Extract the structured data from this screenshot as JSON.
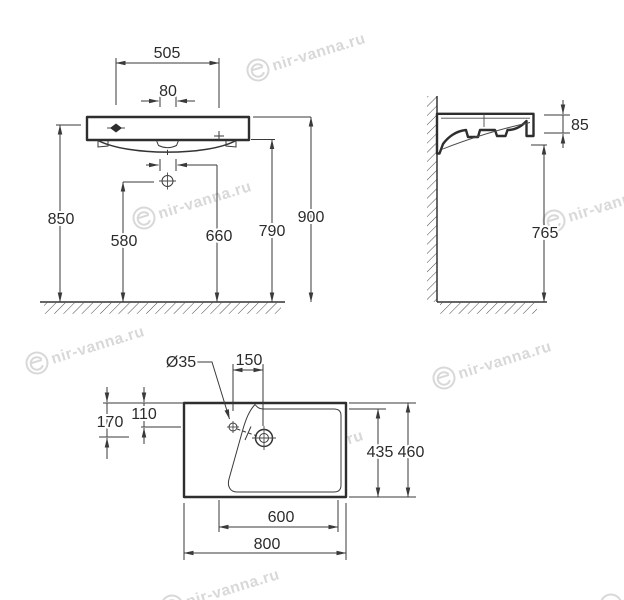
{
  "page": {
    "background": "#ffffff",
    "line_color": "#2e2e2e",
    "text_color": "#2b2b2b"
  },
  "watermark": {
    "text": "nir-vanna.ru",
    "color": "#d5d5d5",
    "logo": "e-in-circle-icon"
  },
  "front_view": {
    "dim_505": "505",
    "dim_80": "80",
    "dim_850": "850",
    "dim_580": "580",
    "dim_660": "660",
    "dim_790": "790",
    "dim_900": "900"
  },
  "side_view": {
    "dim_85": "85",
    "dim_765": "765"
  },
  "top_view": {
    "dim_diameter": "Ø35",
    "dim_150": "150",
    "dim_110": "110",
    "dim_170": "170",
    "dim_435": "435",
    "dim_460": "460",
    "dim_600": "600",
    "dim_800": "800"
  }
}
